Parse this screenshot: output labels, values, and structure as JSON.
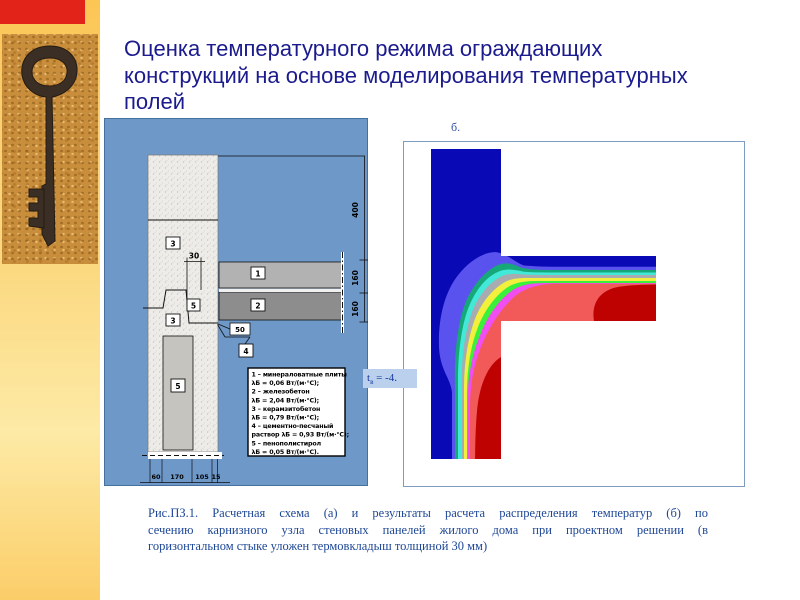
{
  "theme": {
    "accent_red": "#e2231a",
    "sidebar_gold": "#fbcf6a",
    "panel_blue": "#6e98c8",
    "title_color": "#1b1b8e",
    "caption_color": "#1e4796"
  },
  "slide": {
    "title_lines": [
      "Оценка температурного режима ограждающих",
      "конструкций на основе моделирования температурных",
      "полей"
    ],
    "caption_lines": [
      "Рис.ПЗ.1. Расчетная схема (а) и результаты расчета распределения температур (б) по",
      "сечению карнизного узла стеновых панелей жилого дома при проектном решении (в",
      "горизонтальном стыке уложен термовкладыш толщиной 30 мм)"
    ]
  },
  "figure_a": {
    "dims": {
      "height_overall": "400",
      "panel1_height": "160",
      "panel2_height": "160",
      "insert_width": "30",
      "step": "50",
      "bottom": [
        "60",
        "170",
        "105",
        "15"
      ]
    },
    "callouts": {
      "wall_upper": "3",
      "panel_1": "1",
      "joint": "5",
      "panel_2": "2",
      "wall_lower": "3",
      "mortar": "4",
      "insulation": "5"
    },
    "legend_lines": [
      "1 – минераловатные плиты",
      "λБ = 0,06 Вт/(м·°С);",
      "2 – железобетон",
      "λБ = 2,04 Вт/(м·°С);",
      "3 – керамзитобетон",
      "λБ = 0,79 Вт/(м·°С);",
      "4 – цементно-песчаный",
      "раствор λБ = 0,93 Вт/(м·°С);",
      "5 – пенополистирол",
      "λБ = 0,05 Вт/(м·°С)."
    ],
    "temp_label": {
      "symbol": "t",
      "subscript": "в",
      "value": " = -4."
    }
  },
  "figure_b": {
    "label": "б.",
    "bands": [
      "#0909b6",
      "#5a52ee",
      "#16a878",
      "#42e8d8",
      "#a8abb0",
      "#f2f03c",
      "#3af03a",
      "#f04ef0",
      "#f25a5a",
      "#be0202"
    ]
  }
}
